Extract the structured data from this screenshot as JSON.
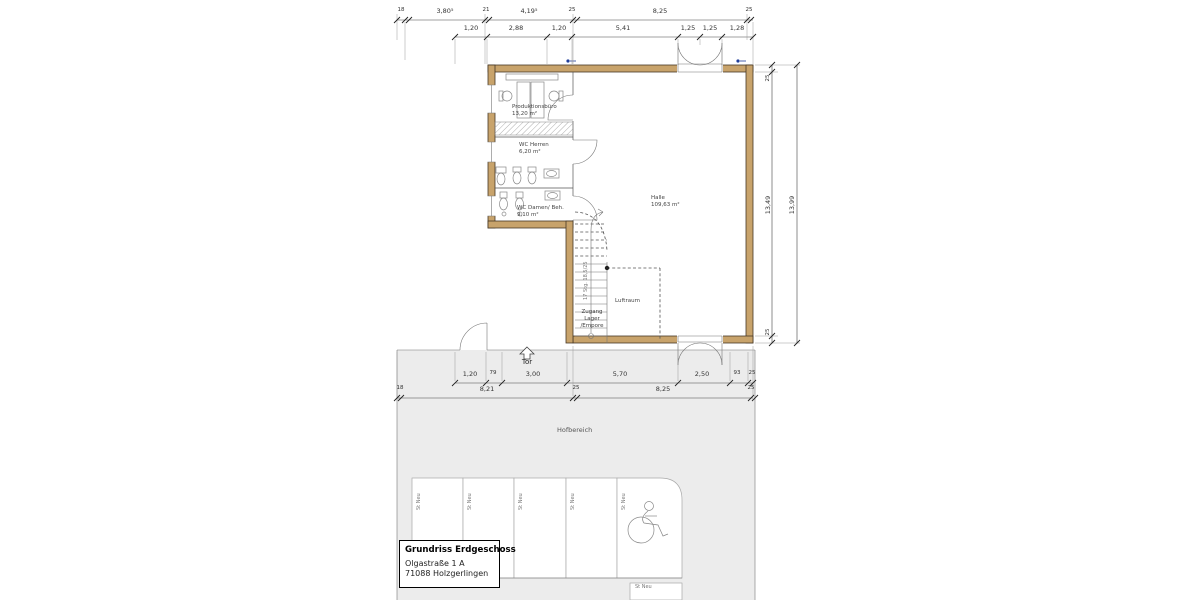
{
  "plan": {
    "title_block": {
      "title": "Grundriss Erdgeschoss",
      "address1": "Olgastraße 1 A",
      "address2": "71088 Holzgerlingen"
    },
    "rooms": {
      "produktionsbuero": {
        "name": "Produktionsbüro",
        "area": "13,20 m²"
      },
      "wc_herren": {
        "name": "WC Herren",
        "area": "6,20 m²"
      },
      "wc_damen": {
        "name": "WC Damen/ Beh.",
        "area": "9,10 m²"
      },
      "halle": {
        "name": "Halle",
        "area": "109,63 m²"
      },
      "luftraum": {
        "name": "Luftraum"
      },
      "zugang": {
        "line1": "Zugang",
        "line2": "Lager",
        "line3": "/Empore"
      }
    },
    "labels": {
      "tor": "Tor",
      "hofbereich": "Hofbereich",
      "stair_note": "17 Stg. 18,5/25",
      "stall": "St Neu"
    },
    "dimensions": {
      "top1": {
        "d0": "18",
        "d1": "3,80⁵",
        "d2": "21",
        "d3": "4,19⁵",
        "d4": "25",
        "d5": "8,25",
        "d6": "25"
      },
      "top2": {
        "d0": "1,20",
        "d1": "2,88",
        "d2": "1,20",
        "d3": "5,41",
        "d4": "1,25",
        "d5": "1,25",
        "d6": "1,28"
      },
      "bottom1": {
        "d0": "1,20",
        "d1": "79",
        "d2": "3,00",
        "d3": "5,70",
        "d4": "2,50",
        "d5": "93",
        "d6": "25"
      },
      "bottom2": {
        "d0": "18",
        "d1": "8,21",
        "d2": "25",
        "d3": "8,25",
        "d4": "25"
      },
      "right": {
        "inner_top": "25",
        "inner": "13,49",
        "inner_bottom": "25",
        "outer": "13,99"
      }
    },
    "colors": {
      "wall": "#c8a36b",
      "wall_outline": "#473826",
      "ground": "#ececec",
      "line": "#555555",
      "accent_blue": "#1f3d99"
    }
  }
}
